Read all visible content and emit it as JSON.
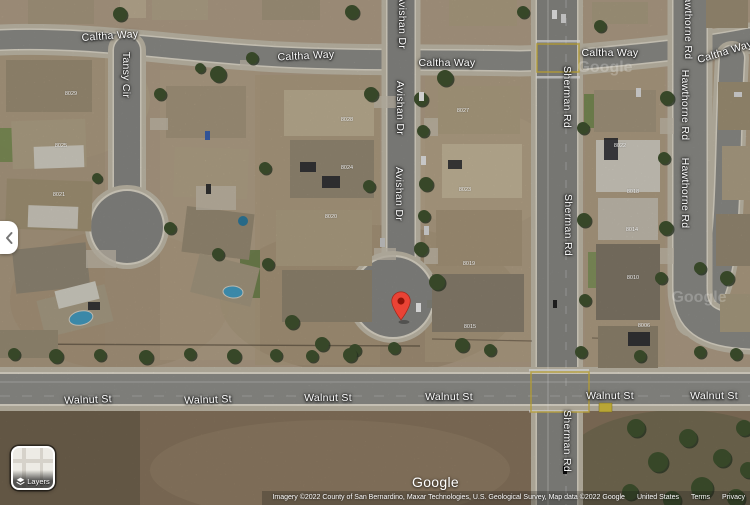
{
  "map": {
    "street_labels": [
      {
        "text": "Caltha Way",
        "x": 110,
        "y": 36,
        "rot": -4
      },
      {
        "text": "Caltha Way",
        "x": 306,
        "y": 56,
        "rot": -3
      },
      {
        "text": "Caltha Way",
        "x": 447,
        "y": 63,
        "rot": 0
      },
      {
        "text": "Caltha Way",
        "x": 610,
        "y": 53,
        "rot": 0
      },
      {
        "text": "Caltha Way",
        "x": 725,
        "y": 52,
        "rot": -17
      },
      {
        "text": "Tansy Cir",
        "x": 126,
        "y": 75,
        "rot": 90
      },
      {
        "text": "Avishan Dr",
        "x": 402,
        "y": 22,
        "rot": 90
      },
      {
        "text": "Avishan Dr",
        "x": 400,
        "y": 108,
        "rot": 90
      },
      {
        "text": "Avishan Dr",
        "x": 399,
        "y": 194,
        "rot": 90
      },
      {
        "text": "Sherman Rd",
        "x": 567,
        "y": 97,
        "rot": 90
      },
      {
        "text": "Sherman Rd",
        "x": 568,
        "y": 225,
        "rot": 90
      },
      {
        "text": "Sherman Rd",
        "x": 567,
        "y": 441,
        "rot": 90
      },
      {
        "text": "Hawthorne Rd",
        "x": 688,
        "y": 24,
        "rot": 90
      },
      {
        "text": "Hawthorne Rd",
        "x": 685,
        "y": 105,
        "rot": 90
      },
      {
        "text": "Hawthorne Rd",
        "x": 685,
        "y": 193,
        "rot": 90
      },
      {
        "text": "Walnut St",
        "x": 88,
        "y": 400,
        "rot": -2
      },
      {
        "text": "Walnut St",
        "x": 208,
        "y": 400,
        "rot": -2
      },
      {
        "text": "Walnut St",
        "x": 328,
        "y": 398,
        "rot": 0
      },
      {
        "text": "Walnut St",
        "x": 449,
        "y": 397,
        "rot": 0
      },
      {
        "text": "Walnut St",
        "x": 610,
        "y": 396,
        "rot": 0
      },
      {
        "text": "Walnut St",
        "x": 714,
        "y": 396,
        "rot": 0
      }
    ],
    "house_numbers": [
      {
        "text": "8029",
        "x": 71,
        "y": 94
      },
      {
        "text": "8025",
        "x": 61,
        "y": 146
      },
      {
        "text": "8021",
        "x": 59,
        "y": 195
      },
      {
        "text": "8028",
        "x": 347,
        "y": 120
      },
      {
        "text": "8024",
        "x": 347,
        "y": 168
      },
      {
        "text": "8020",
        "x": 331,
        "y": 217
      },
      {
        "text": "8027",
        "x": 463,
        "y": 111
      },
      {
        "text": "8023",
        "x": 465,
        "y": 190
      },
      {
        "text": "8019",
        "x": 469,
        "y": 264
      },
      {
        "text": "8015",
        "x": 470,
        "y": 327
      },
      {
        "text": "8022",
        "x": 620,
        "y": 146
      },
      {
        "text": "8018",
        "x": 633,
        "y": 192
      },
      {
        "text": "8014",
        "x": 632,
        "y": 230
      },
      {
        "text": "8010",
        "x": 633,
        "y": 278
      },
      {
        "text": "8006",
        "x": 644,
        "y": 326
      }
    ],
    "watermarks": [
      {
        "text": "Google",
        "x": 605,
        "y": 68
      },
      {
        "text": "Google",
        "x": 699,
        "y": 298
      }
    ],
    "pin": {
      "color": "#EA4335",
      "inner_color": "#8E1308",
      "x": 401,
      "y": 321
    }
  },
  "icons": {
    "collapse": "chevron-left-icon",
    "layers": "layers-diamond-icon"
  },
  "controls": {
    "layers": {
      "label": "Layers"
    }
  },
  "footer": {
    "logo": "Google",
    "attribution": "Imagery ©2022 County of San Bernardino, Maxar Technologies, U.S. Geological Survey, Map data ©2022 Google",
    "links": [
      "United States",
      "Terms",
      "Privacy"
    ]
  },
  "colors": {
    "dirt": "#b3a189",
    "road": "#8f8f8b",
    "field": "#8a775f",
    "pin": "#EA4335"
  }
}
